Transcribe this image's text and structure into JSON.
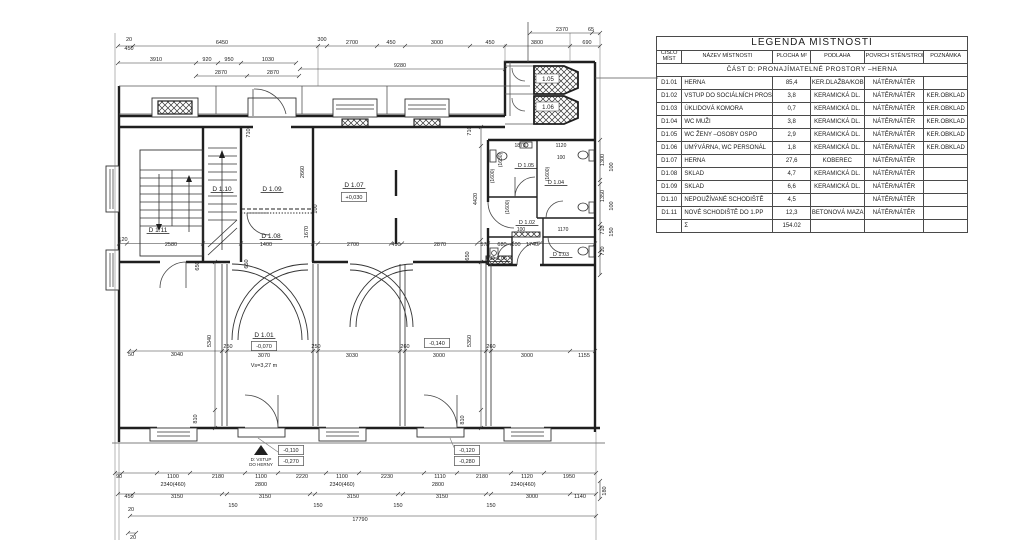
{
  "legend": {
    "title": "LEGENDA MÍSTNOSTÍ",
    "col_headers": [
      "ČÍSLO MÍST",
      "NÁZEV MÍSTNOSTI",
      "PLOCHA",
      "M²",
      "PODLAHA",
      "POVRCH STĚN/STROPU",
      "POZNÁMKA"
    ],
    "section": "ČÁST D: PRONAJÍMATELNÉ PROSTORY –HERNA",
    "rows": [
      {
        "num": "D1.01",
        "name": "HERNA",
        "area": "85,4",
        "floor": "KER.DLAŽBA/KOBEREC",
        "walls": "NÁTĚR/NÁTĚR",
        "note": ""
      },
      {
        "num": "D1.02",
        "name": "VSTUP DO SOCIÁLNÍCH PROSTOR",
        "area": "3,8",
        "floor": "KERAMICKÁ DL.",
        "walls": "NÁTĚR/NÁTĚR",
        "note": "KER.OBKLAD"
      },
      {
        "num": "D1.03",
        "name": "ÚKLIDOVÁ KOMORA",
        "area": "0,7",
        "floor": "KERAMICKÁ DL.",
        "walls": "NÁTĚR/NÁTĚR",
        "note": "KER.OBKLAD"
      },
      {
        "num": "D1.04",
        "name": "WC MUŽI",
        "area": "3,8",
        "floor": "KERAMICKÁ DL.",
        "walls": "NÁTĚR/NÁTĚR",
        "note": "KER.OBKLAD"
      },
      {
        "num": "D1.05",
        "name": "WC ŽENY –OSOBY OSPO",
        "area": "2,9",
        "floor": "KERAMICKÁ DL.",
        "walls": "NÁTĚR/NÁTĚR",
        "note": "KER.OBKLAD"
      },
      {
        "num": "D1.06",
        "name": "UMÝVÁRNA, WC PERSONÁL",
        "area": "1,8",
        "floor": "KERAMICKÁ DL.",
        "walls": "NÁTĚR/NÁTĚR",
        "note": "KER.OBKLAD"
      },
      {
        "num": "D1.07",
        "name": "HERNA",
        "area": "27,6",
        "floor": "KOBEREC",
        "walls": "NÁTĚR/NÁTĚR",
        "note": ""
      },
      {
        "num": "D1.08",
        "name": "SKLAD",
        "area": "4,7",
        "floor": "KERAMICKÁ DL.",
        "walls": "NÁTĚR/NÁTĚR",
        "note": ""
      },
      {
        "num": "D1.09",
        "name": "SKLAD",
        "area": "6,6",
        "floor": "KERAMICKÁ DL.",
        "walls": "NÁTĚR/NÁTĚR",
        "note": ""
      },
      {
        "num": "D1.10",
        "name": "NEPOUŽÍVANÉ SCHODIŠTĚ",
        "area": "4,5",
        "floor": "",
        "walls": "NÁTĚR/NÁTĚR",
        "note": ""
      },
      {
        "num": "D1.11",
        "name": "NOVÉ SCHODIŠTĚ DO 1.PP",
        "area": "12,3",
        "floor": "BETONOVÁ MAZANINA",
        "walls": "NÁTĚR/NÁTĚR",
        "note": ""
      }
    ],
    "sum_label": "Σ",
    "sum_area": "154.02"
  },
  "plan": {
    "entrance_note_line1": "D: VSTUP",
    "entrance_note_line2": "DO HERNY",
    "texts": [
      {
        "t": "20",
        "x": 129,
        "y": 41
      },
      {
        "t": "450",
        "x": 129,
        "y": 50
      },
      {
        "t": "6450",
        "x": 222,
        "y": 44
      },
      {
        "t": "300",
        "x": 322,
        "y": 41
      },
      {
        "t": "2700",
        "x": 352,
        "y": 44
      },
      {
        "t": "450",
        "x": 391,
        "y": 44
      },
      {
        "t": "3000",
        "x": 437,
        "y": 44
      },
      {
        "t": "450",
        "x": 490,
        "y": 44
      },
      {
        "t": "3800",
        "x": 537,
        "y": 44
      },
      {
        "t": "690",
        "x": 587,
        "y": 44
      },
      {
        "t": "2370",
        "x": 562,
        "y": 31
      },
      {
        "t": "65",
        "x": 591,
        "y": 31
      },
      {
        "t": "3910",
        "x": 156,
        "y": 61
      },
      {
        "t": "920",
        "x": 207,
        "y": 61
      },
      {
        "t": "950",
        "x": 229,
        "y": 61
      },
      {
        "t": "1030",
        "x": 268,
        "y": 61
      },
      {
        "t": "2870",
        "x": 221,
        "y": 74
      },
      {
        "t": "2870",
        "x": 273,
        "y": 74
      },
      {
        "t": "9280",
        "x": 400,
        "y": 67
      },
      {
        "t": "710",
        "x": 250,
        "y": 133,
        "r": 1
      },
      {
        "t": "710",
        "x": 471,
        "y": 131,
        "r": 1
      },
      {
        "t": "2660",
        "x": 304,
        "y": 172,
        "r": 1
      },
      {
        "t": "1670",
        "x": 308,
        "y": 232,
        "r": 1
      },
      {
        "t": "100",
        "x": 317,
        "y": 209,
        "r": 1
      },
      {
        "t": "4420",
        "x": 477,
        "y": 199,
        "r": 1
      },
      {
        "t": "650",
        "x": 469,
        "y": 256,
        "r": 1
      },
      {
        "t": "650",
        "x": 248,
        "y": 264,
        "r": 1
      },
      {
        "t": "650",
        "x": 199,
        "y": 266,
        "r": 1
      },
      {
        "t": "D 1.11",
        "x": 158,
        "y": 232,
        "s": 6.5,
        "u": 1,
        "n": "room-label-d1-11"
      },
      {
        "t": "D 1.10",
        "x": 222,
        "y": 191,
        "s": 6.5,
        "u": 1,
        "n": "room-label-d1-10"
      },
      {
        "t": "D 1.09",
        "x": 272,
        "y": 191,
        "s": 6.5,
        "u": 1,
        "n": "room-label-d1-09"
      },
      {
        "t": "D 1.08",
        "x": 271,
        "y": 238,
        "s": 6.5,
        "u": 1,
        "n": "room-label-d1-08"
      },
      {
        "t": "D 1.07",
        "x": 354,
        "y": 187,
        "s": 6.5,
        "u": 1,
        "n": "room-label-d1-07"
      },
      {
        "t": "+0,030",
        "x": 354,
        "y": 199,
        "b": 1,
        "n": "level-d1-07"
      },
      {
        "t": "1.05",
        "x": 548,
        "y": 81,
        "s": 6,
        "n": "room-label-1-05"
      },
      {
        "t": "1.06",
        "x": 548,
        "y": 109,
        "s": 6,
        "n": "room-label-1-06"
      },
      {
        "t": "1870",
        "x": 520,
        "y": 147,
        "s": 5
      },
      {
        "t": "1120",
        "x": 561,
        "y": 147,
        "s": 5
      },
      {
        "t": "100",
        "x": 561,
        "y": 159,
        "s": 5
      },
      {
        "t": "(1630)",
        "x": 502,
        "y": 160,
        "r": 1,
        "s": 5
      },
      {
        "t": "(1600)",
        "x": 494,
        "y": 176,
        "r": 1,
        "s": 5
      },
      {
        "t": "(1600)",
        "x": 549,
        "y": 174,
        "r": 1,
        "s": 5
      },
      {
        "t": "(1600)",
        "x": 509,
        "y": 207,
        "r": 1,
        "s": 5
      },
      {
        "t": "D 1.05",
        "x": 526,
        "y": 167,
        "s": 5.5,
        "u": 1,
        "n": "room-label-d1-05"
      },
      {
        "t": "D 1.04",
        "x": 556,
        "y": 184,
        "s": 5.5,
        "u": 1,
        "n": "room-label-d1-04"
      },
      {
        "t": "D 1.02",
        "x": 527,
        "y": 224,
        "s": 5.5,
        "u": 1,
        "n": "room-label-d1-02"
      },
      {
        "t": "100",
        "x": 521,
        "y": 231,
        "s": 5
      },
      {
        "t": "1170",
        "x": 563,
        "y": 231,
        "s": 5
      },
      {
        "t": "D 1.03",
        "x": 561,
        "y": 256,
        "s": 5.5,
        "u": 1,
        "n": "room-label-d1-03"
      },
      {
        "t": "D 1.06",
        "x": 499,
        "y": 260,
        "s": 5.5,
        "u": 1,
        "n": "room-label-d1-06"
      },
      {
        "t": "120",
        "x": 123,
        "y": 241
      },
      {
        "t": "2580",
        "x": 171,
        "y": 246
      },
      {
        "t": "1400",
        "x": 266,
        "y": 246
      },
      {
        "t": "2700",
        "x": 353,
        "y": 246
      },
      {
        "t": "490",
        "x": 396,
        "y": 246
      },
      {
        "t": "2870",
        "x": 440,
        "y": 246
      },
      {
        "t": "570",
        "x": 485,
        "y": 246
      },
      {
        "t": "680",
        "x": 502,
        "y": 246
      },
      {
        "t": "100",
        "x": 516,
        "y": 246
      },
      {
        "t": "1740",
        "x": 532,
        "y": 246
      },
      {
        "t": "1300",
        "x": 604,
        "y": 160,
        "r": 1
      },
      {
        "t": "100",
        "x": 613,
        "y": 167,
        "r": 1
      },
      {
        "t": "1350",
        "x": 604,
        "y": 196,
        "r": 1
      },
      {
        "t": "100",
        "x": 613,
        "y": 206,
        "r": 1
      },
      {
        "t": "710",
        "x": 604,
        "y": 230,
        "r": 1
      },
      {
        "t": "150",
        "x": 613,
        "y": 232,
        "r": 1
      },
      {
        "t": "710",
        "x": 604,
        "y": 251,
        "r": 1
      },
      {
        "t": "180",
        "x": 606,
        "y": 491,
        "r": 1
      },
      {
        "t": "D 1.01",
        "x": 264,
        "y": 337,
        "s": 6.5,
        "u": 1,
        "n": "room-label-d1-01"
      },
      {
        "t": "-0,070",
        "x": 264,
        "y": 348,
        "b": 1,
        "n": "level-d1-01"
      },
      {
        "t": "Vs=3,27 m",
        "x": 264,
        "y": 367,
        "s": 5.5
      },
      {
        "t": "-0,140",
        "x": 437,
        "y": 345,
        "b": 1,
        "n": "level-box"
      },
      {
        "t": "50",
        "x": 131,
        "y": 356
      },
      {
        "t": "3040",
        "x": 177,
        "y": 356
      },
      {
        "t": "5340",
        "x": 211,
        "y": 341,
        "r": 1
      },
      {
        "t": "250",
        "x": 228,
        "y": 348
      },
      {
        "t": "3070",
        "x": 264,
        "y": 357
      },
      {
        "t": "250",
        "x": 316,
        "y": 348
      },
      {
        "t": "3030",
        "x": 352,
        "y": 357
      },
      {
        "t": "260",
        "x": 405,
        "y": 348
      },
      {
        "t": "3000",
        "x": 439,
        "y": 357
      },
      {
        "t": "5350",
        "x": 471,
        "y": 341,
        "r": 1
      },
      {
        "t": "260",
        "x": 491,
        "y": 348
      },
      {
        "t": "3000",
        "x": 527,
        "y": 357
      },
      {
        "t": "1155",
        "x": 584,
        "y": 357
      },
      {
        "t": "810",
        "x": 197,
        "y": 419,
        "r": 1
      },
      {
        "t": "810",
        "x": 464,
        "y": 420,
        "r": 1
      },
      {
        "t": "-0,110",
        "x": 291,
        "y": 452,
        "b": 1,
        "n": "level-box"
      },
      {
        "t": "-0,270",
        "x": 291,
        "y": 463,
        "b": 1,
        "n": "level-box"
      },
      {
        "t": "-0,120",
        "x": 467,
        "y": 452,
        "b": 1,
        "n": "level-box"
      },
      {
        "t": "-0,280",
        "x": 467,
        "y": 463,
        "b": 1,
        "n": "level-box"
      },
      {
        "t": "D: VSTUP",
        "x": 261,
        "y": 461,
        "s": 4.5,
        "n": "entrance-note"
      },
      {
        "t": "DO HERNY",
        "x": 261,
        "y": 466,
        "s": 4.5,
        "n": "entrance-note"
      },
      {
        "t": "90",
        "x": 119,
        "y": 478
      },
      {
        "t": "1100",
        "x": 173,
        "y": 478
      },
      {
        "t": "2180",
        "x": 218,
        "y": 478
      },
      {
        "t": "1100",
        "x": 261,
        "y": 478
      },
      {
        "t": "2220",
        "x": 302,
        "y": 478
      },
      {
        "t": "1100",
        "x": 342,
        "y": 478
      },
      {
        "t": "2230",
        "x": 387,
        "y": 478
      },
      {
        "t": "1110",
        "x": 440,
        "y": 478
      },
      {
        "t": "2180",
        "x": 482,
        "y": 478
      },
      {
        "t": "1120",
        "x": 527,
        "y": 478
      },
      {
        "t": "1950",
        "x": 569,
        "y": 478
      },
      {
        "t": "2340(460)",
        "x": 173,
        "y": 486
      },
      {
        "t": "2800",
        "x": 261,
        "y": 486
      },
      {
        "t": "2340(460)",
        "x": 342,
        "y": 486
      },
      {
        "t": "2800",
        "x": 438,
        "y": 486
      },
      {
        "t": "2340(460)",
        "x": 523,
        "y": 486
      },
      {
        "t": "450",
        "x": 129,
        "y": 498
      },
      {
        "t": "3150",
        "x": 177,
        "y": 498
      },
      {
        "t": "3150",
        "x": 265,
        "y": 498
      },
      {
        "t": "3150",
        "x": 353,
        "y": 498
      },
      {
        "t": "3150",
        "x": 442,
        "y": 498
      },
      {
        "t": "3000",
        "x": 532,
        "y": 498
      },
      {
        "t": "1140",
        "x": 580,
        "y": 498
      },
      {
        "t": "150",
        "x": 233,
        "y": 507
      },
      {
        "t": "150",
        "x": 318,
        "y": 507
      },
      {
        "t": "150",
        "x": 398,
        "y": 507
      },
      {
        "t": "150",
        "x": 491,
        "y": 507
      },
      {
        "t": "20",
        "x": 131,
        "y": 511
      },
      {
        "t": "17790",
        "x": 360,
        "y": 521
      },
      {
        "t": "20",
        "x": 133,
        "y": 539
      }
    ]
  }
}
